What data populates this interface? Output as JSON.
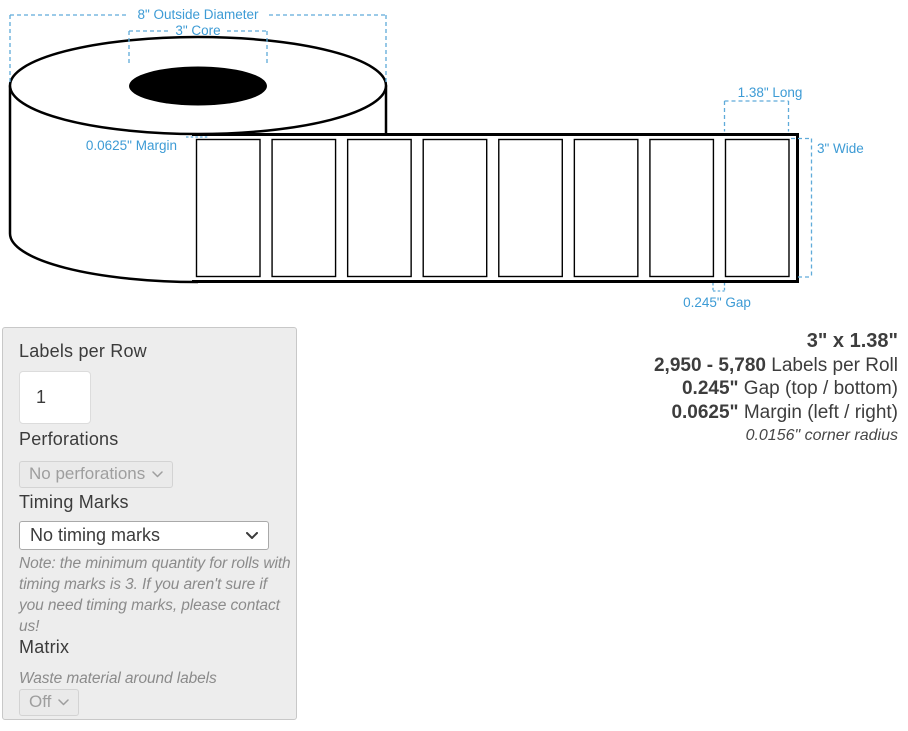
{
  "diagram": {
    "annotations": {
      "outside_diameter": "8\" Outside Diameter",
      "core": "3\" Core",
      "margin": "0.0625\" Margin",
      "long": "1.38\" Long",
      "wide": "3\" Wide",
      "gap": "0.245\" Gap"
    },
    "visible_label_count": 8,
    "colors": {
      "annotation_blue": "#3D9BD5",
      "dash_blue": "#5FABD9",
      "line_black": "#000000"
    }
  },
  "panel": {
    "labels_per_row": {
      "label": "Labels per Row",
      "value": "1"
    },
    "perforations": {
      "label": "Perforations",
      "selected": "No perforations"
    },
    "timing_marks": {
      "label": "Timing Marks",
      "selected": "No timing marks",
      "note": "Note: the minimum quantity for rolls with timing marks is 3. If you aren't sure if you need timing marks, please contact us!"
    },
    "matrix": {
      "label": "Matrix",
      "description": "Waste material around labels",
      "selected": "Off"
    }
  },
  "summary": {
    "size": "3\" x 1.38\"",
    "labels_per_roll": {
      "value": "2,950 - 5,780",
      "label": " Labels per Roll"
    },
    "gap": {
      "value": "0.245\"",
      "label": " Gap (top / bottom)"
    },
    "margin": {
      "value": "0.0625\"",
      "label": " Margin (left / right)"
    },
    "corner_radius": "0.0156\" corner radius"
  }
}
